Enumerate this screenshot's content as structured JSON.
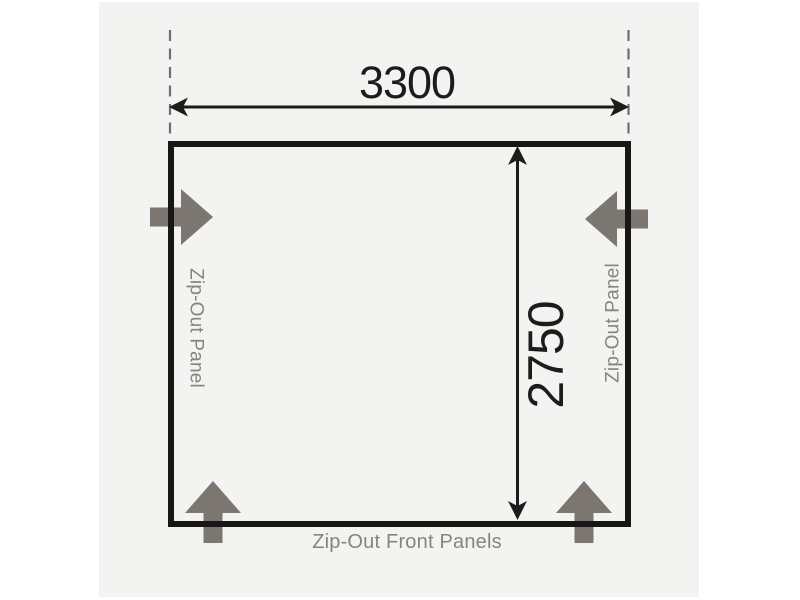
{
  "diagram": {
    "dimensions": {
      "width_label": "3300",
      "depth_label": "2750"
    },
    "labels": {
      "left_panel": "Zip-Out Panel",
      "right_panel": "Zip-Out Panel",
      "front_panels": "Zip-Out Front Panels"
    },
    "colors": {
      "page_background": "#ffffff",
      "canvas_background": "#f3f3f2",
      "outline": "#181716",
      "dimension": "#1d1c1b",
      "dashed_guide": "#6e6e6e",
      "block_arrow": "#7c7670",
      "label_text": "#878381"
    }
  }
}
